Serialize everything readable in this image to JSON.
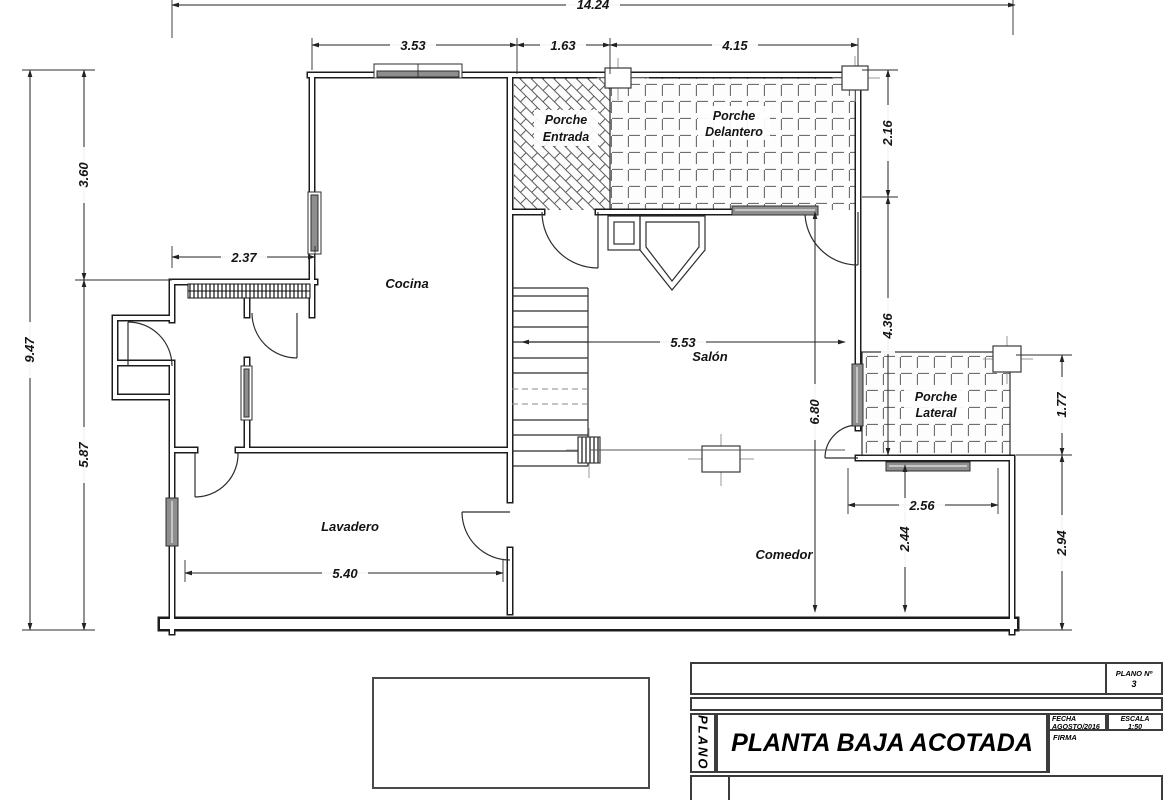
{
  "plan": {
    "rooms": {
      "cocina": "Cocina",
      "salon": "Salón",
      "lavadero": "Lavadero",
      "comedor": "Comedor",
      "porche_entrada_1": "Porche",
      "porche_entrada_2": "Entrada",
      "porche_delantero_1": "Porche",
      "porche_delantero_2": "Delantero",
      "porche_lateral_1": "Porche",
      "porche_lateral_2": "Lateral"
    },
    "dims": {
      "total": "14.24",
      "t1": "3.53",
      "t2": "1.63",
      "t3": "4.15",
      "l_total": "9.47",
      "l1": "3.60",
      "l2": "5.87",
      "hall": "2.37",
      "r1": "2.16",
      "r2": "4.36",
      "pl_h": "1.77",
      "r3": "2.94",
      "ext_w": "2.56",
      "ext_h": "2.44",
      "salon_w": "5.53",
      "salon_h": "6.80",
      "lav_w": "5.40"
    },
    "colors": {
      "line": "#1c1c1c",
      "window_fill": "#8e8e8e",
      "tile_joint": "#6f6f6f"
    }
  },
  "title_block": {
    "plano_vertical": "PLANO",
    "plano_no_label": "PLANO Nº",
    "plano_no_value": "3",
    "title": "PLANTA BAJA ACOTADA",
    "fecha_label": "FECHA",
    "fecha_value": "AGOSTO/2016",
    "escala_label": "ESCALA",
    "escala_value": "1:50",
    "firma_label": "FIRMA"
  }
}
